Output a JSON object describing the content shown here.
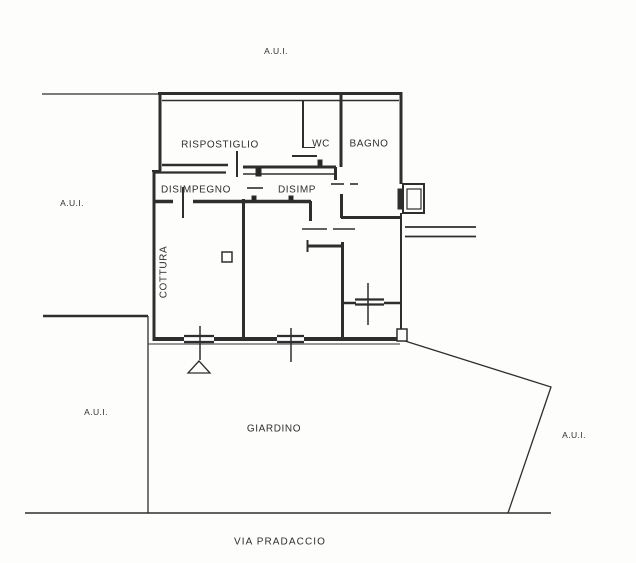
{
  "drawing_title": "Planimetria catastale / floor plan",
  "labels": {
    "aui_top": "A.U.I.",
    "aui_left": "A.U.I.",
    "aui_bottom_left": "A.U.I.",
    "aui_right": "A.U.I.",
    "ripostiglio": "RISPOSTIGLIO",
    "wc": "WC",
    "bagno": "BAGNO",
    "disimpegno": "DISIMPEGNO",
    "disimp": "DISIMP",
    "cottura": "COTTURA",
    "giardino": "GIARDINO",
    "street": "VIA PRADACCIO"
  },
  "colors": {
    "line": "#2e2e2e",
    "background": "#fdfdfc"
  }
}
